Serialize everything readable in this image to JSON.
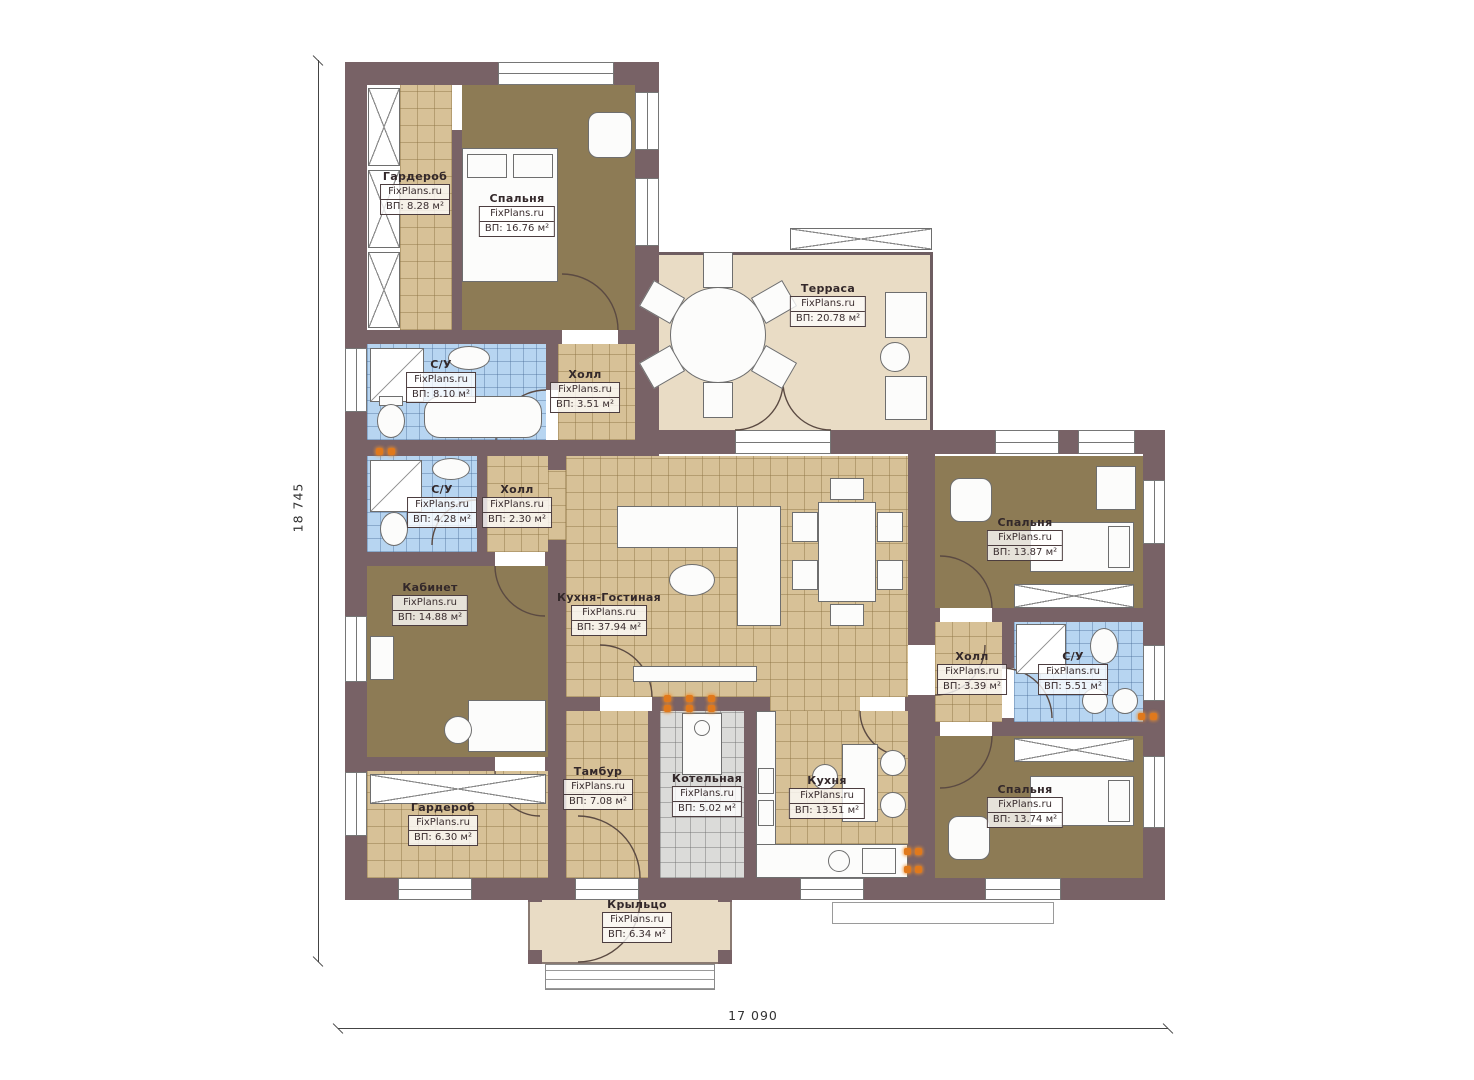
{
  "watermark": "FixPlans.ru",
  "dimensions": {
    "left": "18 745",
    "bottom": "17 090"
  },
  "palette": {
    "wall": "#786266",
    "floor_tan": "#d7c197",
    "floor_brown": "#8d7b55",
    "floor_blue": "#b7d5f1",
    "floor_gray": "#dbdbd9",
    "floor_beige": "#e9dcc5",
    "accent_orange": "#e0791c"
  },
  "rooms": [
    {
      "name": "Гардероб",
      "area": "ВП: 8.28 м²"
    },
    {
      "name": "Спальня",
      "area": "ВП: 16.76 м²"
    },
    {
      "name": "С/У",
      "area": "ВП: 8.10 м²"
    },
    {
      "name": "Холл",
      "area": "ВП: 3.51 м²"
    },
    {
      "name": "Терраса",
      "area": "ВП: 20.78 м²"
    },
    {
      "name": "С/У",
      "area": "ВП: 4.28 м²"
    },
    {
      "name": "Холл",
      "area": "ВП: 2.30 м²"
    },
    {
      "name": "Кабинет",
      "area": "ВП: 14.88 м²"
    },
    {
      "name": "Кухня-Гостиная",
      "area": "ВП: 37.94 м²"
    },
    {
      "name": "Спальня",
      "area": "ВП: 13.87 м²"
    },
    {
      "name": "Холл",
      "area": "ВП: 3.39 м²"
    },
    {
      "name": "С/У",
      "area": "ВП: 5.51 м²"
    },
    {
      "name": "Тамбур",
      "area": "ВП: 7.08 м²"
    },
    {
      "name": "Котельная",
      "area": "ВП: 5.02 м²"
    },
    {
      "name": "Кухня",
      "area": "ВП: 13.51 м²"
    },
    {
      "name": "Гардероб",
      "area": "ВП: 6.30 м²"
    },
    {
      "name": "Спальня",
      "area": "ВП: 13.74 м²"
    },
    {
      "name": "Крыльцо",
      "area": "ВП: 6.34 м²"
    }
  ]
}
